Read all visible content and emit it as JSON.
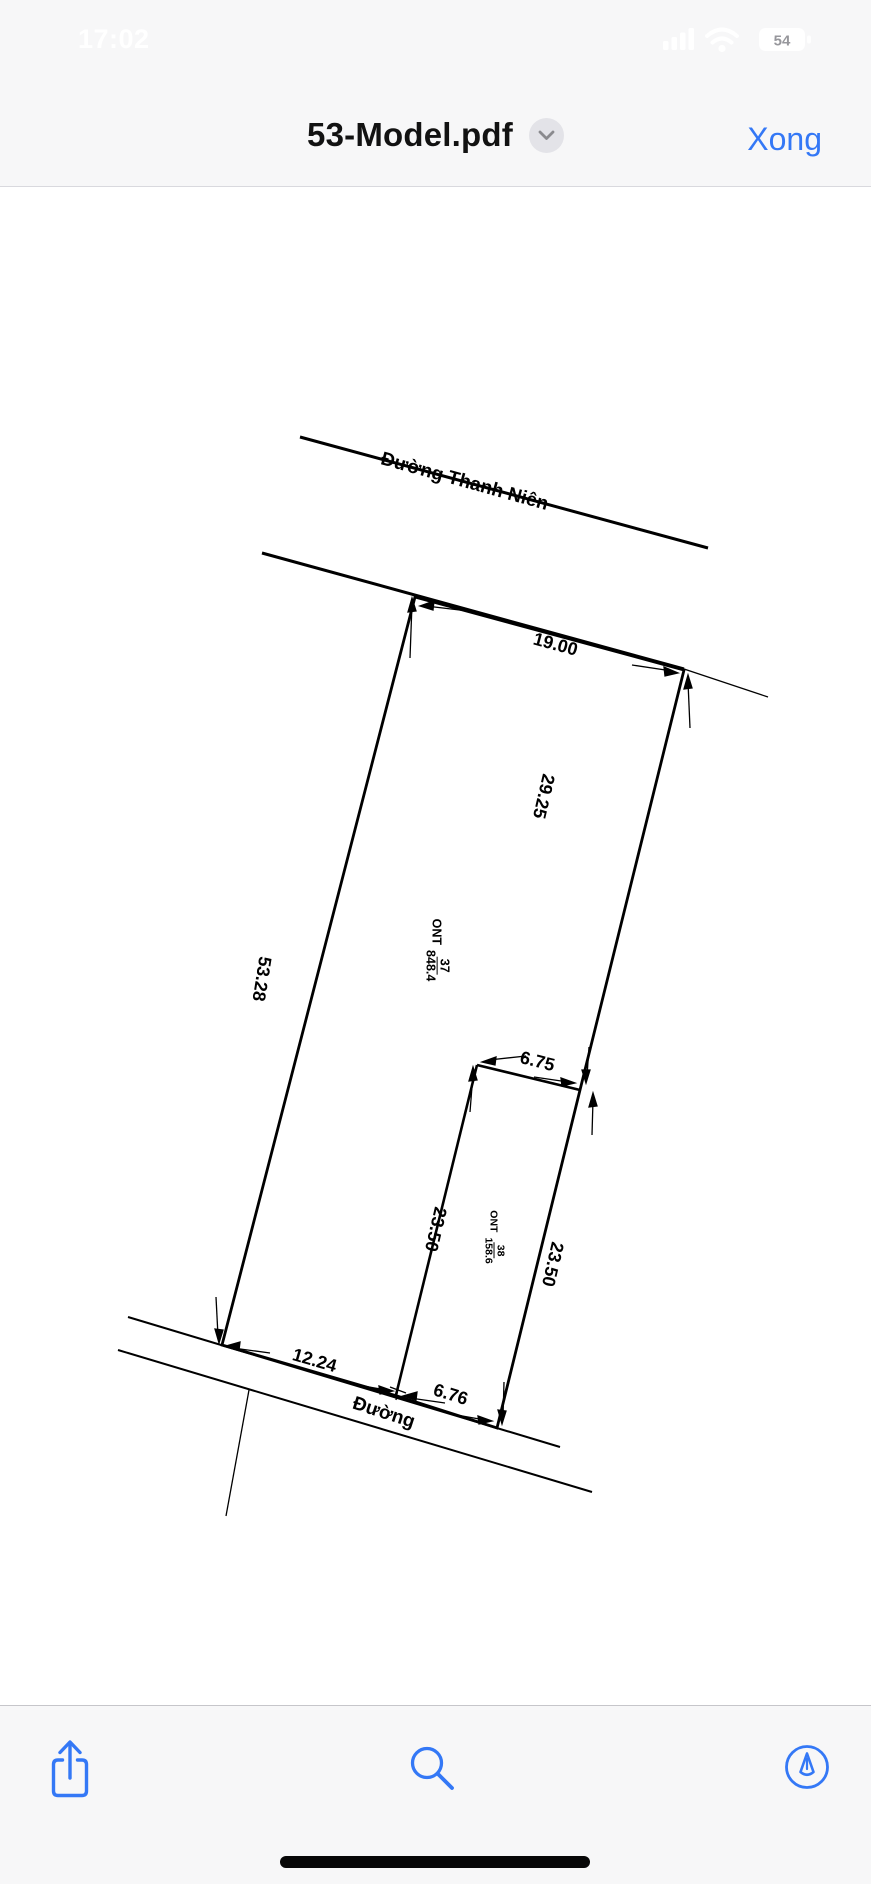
{
  "status_bar": {
    "time": "17:02",
    "battery_percent": "54"
  },
  "nav_bar": {
    "title": "53-Model.pdf",
    "done_button": "Xong"
  },
  "document": {
    "roads": {
      "top": "Đường Thanh Niên",
      "bottom": "Đường"
    },
    "dimensions": {
      "frontage_top": "19.00",
      "right_upper": "29.25",
      "left_side": "53.28",
      "inner_left": "23.50",
      "right_lower": "23.50",
      "inner_top": "6.75",
      "bottom_left": "12.24",
      "bottom_right": "6.76"
    },
    "parcels": {
      "main": {
        "code": "ONT",
        "number": "37",
        "area": "848.4"
      },
      "inner": {
        "code": "ONT",
        "number": "38",
        "area": "158.6"
      }
    }
  },
  "toolbar": {
    "icons": [
      "share-icon",
      "search-icon",
      "markup-icon"
    ]
  },
  "colors": {
    "accent": "#3478f6",
    "ink": "#000000",
    "chrome_bg": "#f7f7f8"
  }
}
